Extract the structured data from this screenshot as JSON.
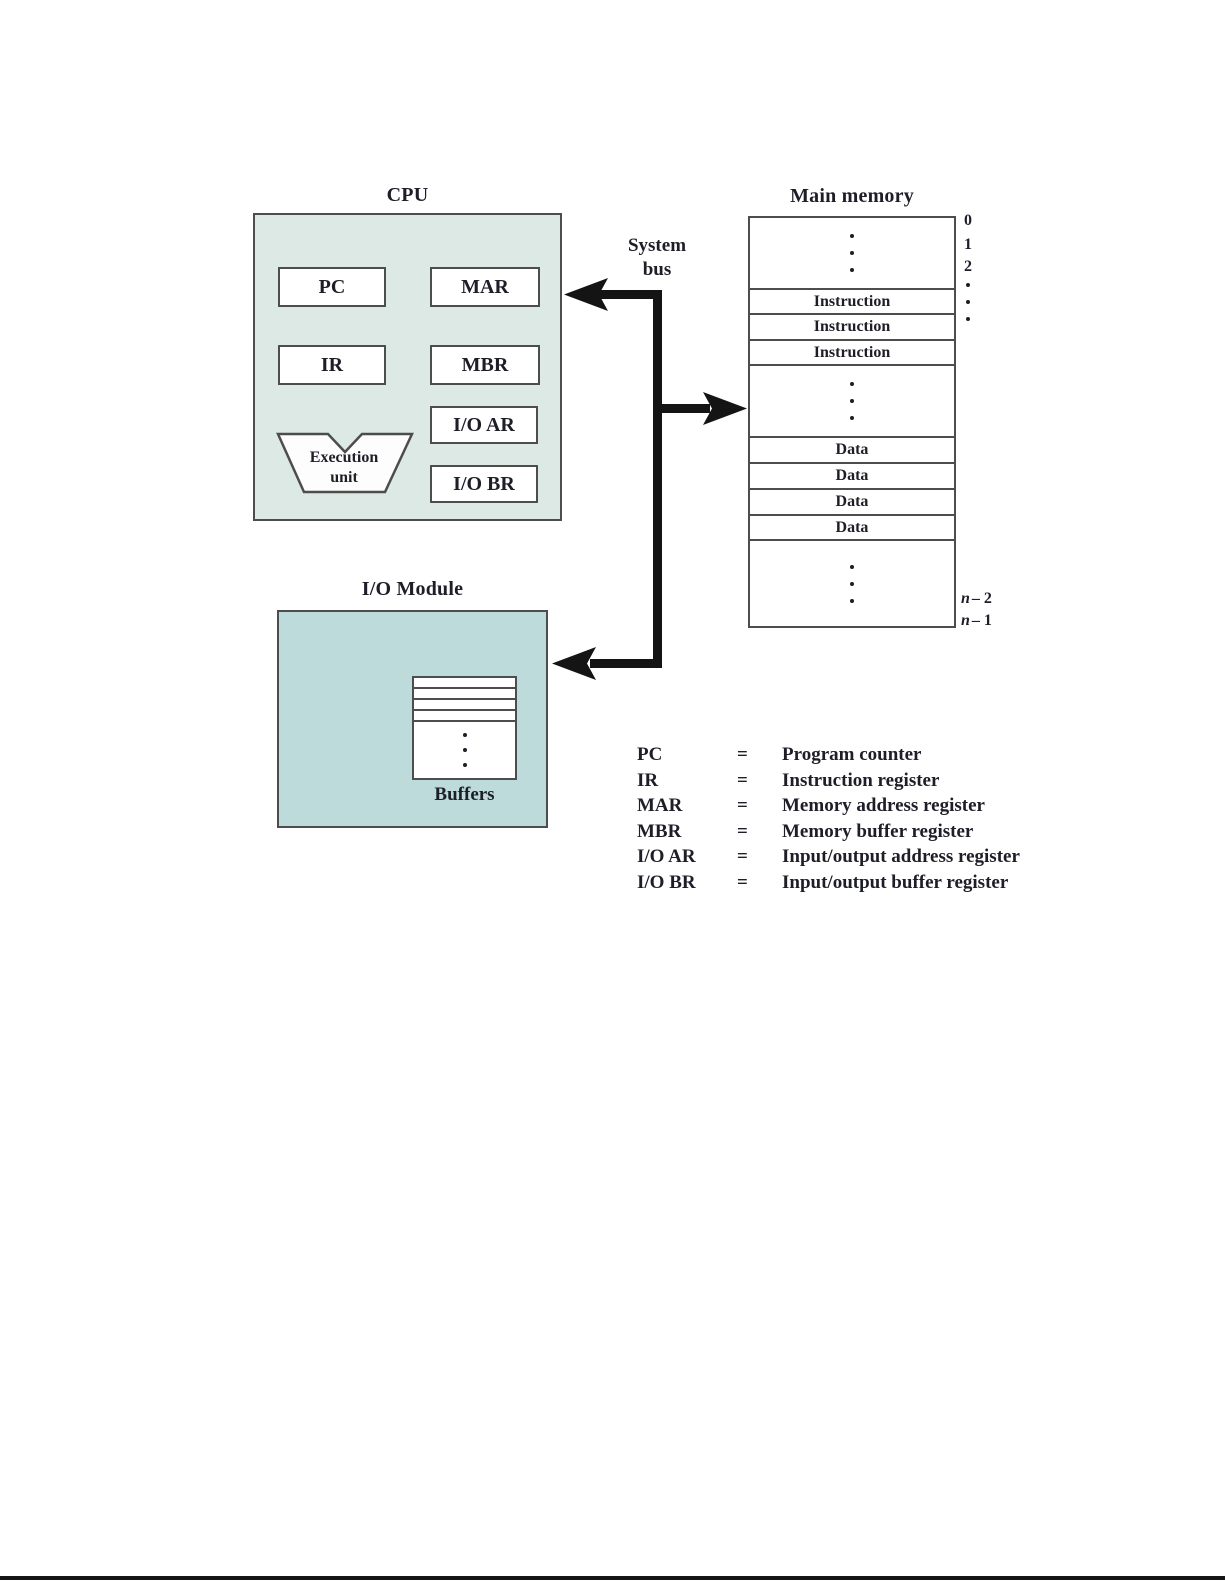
{
  "cpu": {
    "title": "CPU",
    "registers": {
      "pc": "PC",
      "mar": "MAR",
      "ir": "IR",
      "mbr": "MBR",
      "io_ar": "I/O AR",
      "io_br": "I/O BR"
    },
    "execution_unit": {
      "line1": "Execution",
      "line2": "unit"
    }
  },
  "system_bus": {
    "line1": "System",
    "line2": "bus"
  },
  "main_memory": {
    "title": "Main memory",
    "rows": [
      {
        "type": "ellipsis"
      },
      {
        "type": "cell",
        "text": "Instruction"
      },
      {
        "type": "cell",
        "text": "Instruction"
      },
      {
        "type": "cell",
        "text": "Instruction"
      },
      {
        "type": "ellipsis"
      },
      {
        "type": "cell",
        "text": "Data"
      },
      {
        "type": "cell",
        "text": "Data"
      },
      {
        "type": "cell",
        "text": "Data"
      },
      {
        "type": "cell",
        "text": "Data"
      },
      {
        "type": "ellipsis"
      }
    ],
    "addresses": {
      "top": [
        "0",
        "1",
        "2"
      ],
      "bottom": [
        {
          "var": "n",
          "rest": "– 2"
        },
        {
          "var": "n",
          "rest": "– 1"
        }
      ]
    }
  },
  "io_module": {
    "title": "I/O Module",
    "buffers_label": "Buffers",
    "buffer_slot_count": 4
  },
  "legend": {
    "entries": [
      {
        "abbr": "PC",
        "eq": "=",
        "desc": "Program counter"
      },
      {
        "abbr": "IR",
        "eq": "=",
        "desc": "Instruction register"
      },
      {
        "abbr": "MAR",
        "eq": "=",
        "desc": "Memory address register"
      },
      {
        "abbr": "MBR",
        "eq": "=",
        "desc": "Memory buffer register"
      },
      {
        "abbr": "I/O AR",
        "eq": "=",
        "desc": "Input/output address register"
      },
      {
        "abbr": "I/O BR",
        "eq": "=",
        "desc": "Input/output buffer register"
      }
    ]
  },
  "colors": {
    "page_bg": "#ffffff",
    "cpu_fill": "#dde9e5",
    "io_fill": "#bcdbda",
    "box_border": "#4d4d4d",
    "text": "#1e1e28",
    "bus": "#141414"
  }
}
